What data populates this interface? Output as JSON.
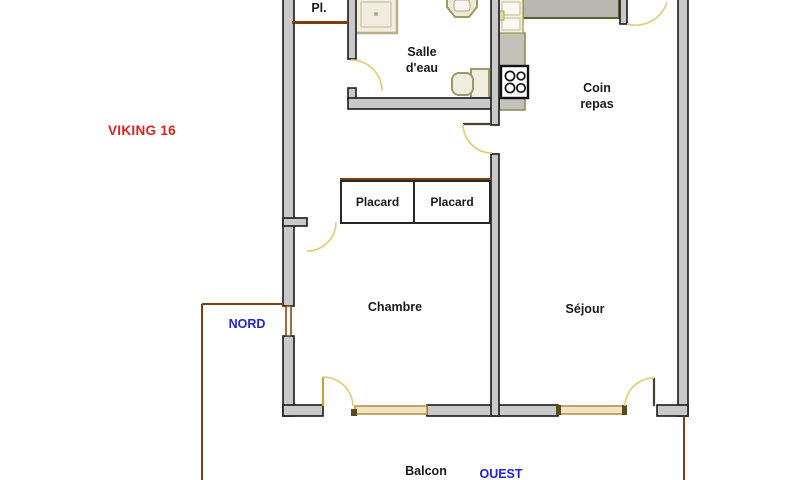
{
  "title": {
    "text": "VIKING 16",
    "color": "#dd2222"
  },
  "orientation": {
    "north": "NORD",
    "west": "OUEST",
    "color": "#2424cc"
  },
  "rooms": {
    "closet_small": "Pl.",
    "bathroom": "Salle\nd'eau",
    "dining": "Coin\nrepas",
    "storage_left": "Placard",
    "storage_right": "Placard",
    "bedroom": "Chambre",
    "living": "Séjour",
    "balcony": "Balcon"
  },
  "fixtures": [
    "shower-tray",
    "washbasin",
    "toilet",
    "kitchen-sink",
    "stove",
    "worktop-top",
    "worktop-side"
  ],
  "colors": {
    "wall_fill": "#c9c9c9",
    "wall_stroke": "#1a1a1a",
    "door_arc": "#e6cc7a",
    "window_fill": "#f2e4c0",
    "window_stroke": "#b08c40",
    "balcony_line": "#7b3f10",
    "fixture_fill": "#f1ede1",
    "fixture_stroke": "#9a9a6a"
  }
}
